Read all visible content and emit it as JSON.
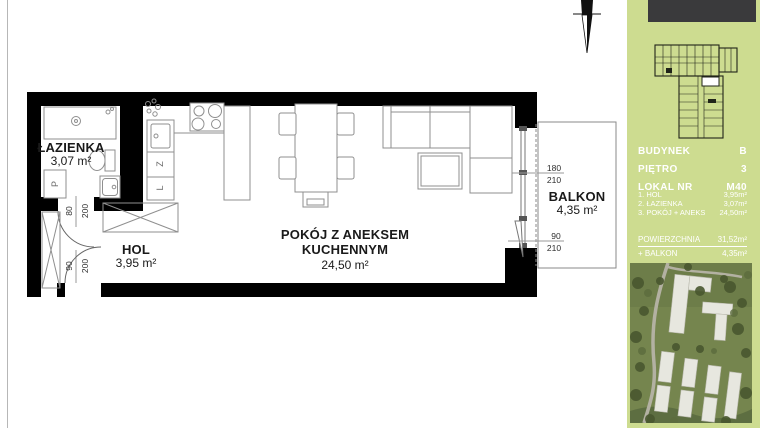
{
  "plan": {
    "bathroom": {
      "name": "ŁAZIENKA",
      "area": "3,07 m²"
    },
    "hall": {
      "name": "HOL",
      "area": "3,95 m²"
    },
    "living": {
      "name_line1": "POKÓJ Z ANEKSEM",
      "name_line2": "KUCHENNYM",
      "area": "24,50 m²"
    },
    "balcony": {
      "name": "BALKON",
      "area": "4,35 m²"
    },
    "dims": {
      "window_w": "180",
      "window_h": "210",
      "balcony_door_w": "90",
      "balcony_door_h": "210",
      "bath_door_w": "80",
      "bath_door_h": "200",
      "entry_door_w": "90",
      "entry_door_h": "200"
    },
    "appliances": {
      "washer": "P",
      "dishwasher": "Z",
      "fridge": "L"
    }
  },
  "sidebar": {
    "info": [
      {
        "label": "BUDYNEK",
        "value": "B"
      },
      {
        "label": "PIĘTRO",
        "value": "3"
      },
      {
        "label": "LOKAL NR",
        "value": "M40"
      }
    ],
    "rooms": [
      {
        "label": "1. HOL",
        "value": "3,95m²"
      },
      {
        "label": "2. ŁAZIENKA",
        "value": "3,07m²"
      },
      {
        "label": "3. POKÓJ + ANEKS",
        "value": "24,50m²"
      }
    ],
    "summary": {
      "area_label": "POWIERZCHNIA",
      "area_value": "31,52m²",
      "balcony_label": "+ BALKON",
      "balcony_value": "4,35m²"
    },
    "colors": {
      "background": "#cddc90",
      "text": "#ffffff",
      "topbar": "#3a3a3c"
    }
  }
}
